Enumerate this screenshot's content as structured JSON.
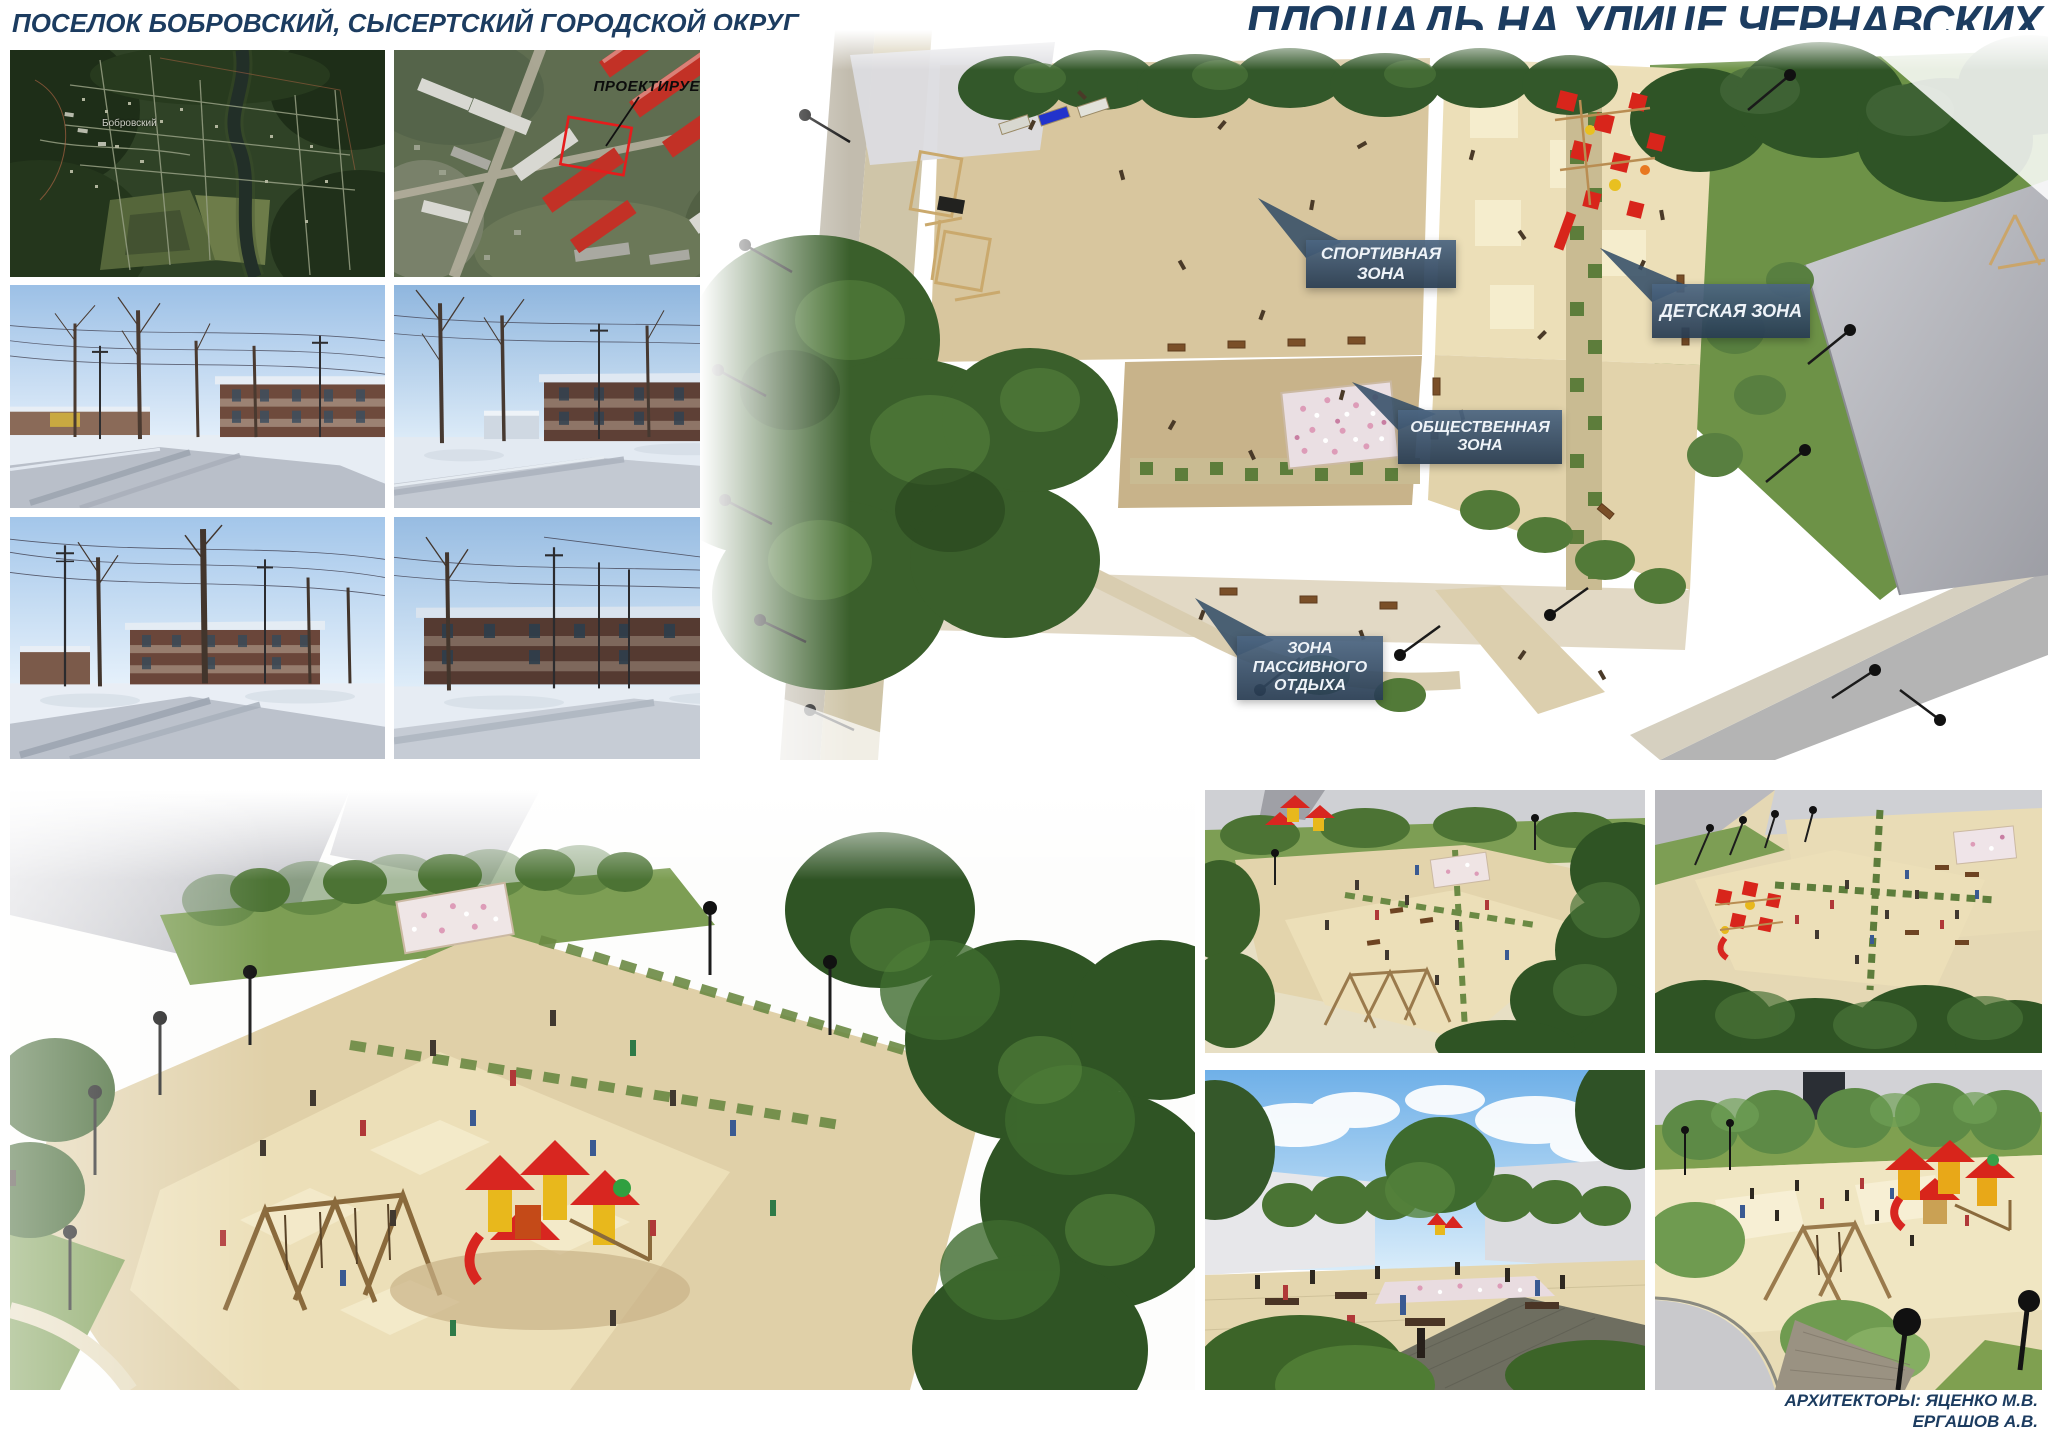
{
  "header": {
    "location_title": "ПОСЕЛОК БОБРОВСКИЙ, СЫСЕРТСКИЙ ГОРОДСКОЙ ОКРУГ",
    "project_title": "ПЛОЩАДЬ НА УЛИЦЕ ЧЕРНАВСКИХ"
  },
  "site_maps": {
    "settlement_label": "Бобровский",
    "project_site_label": "ПРОЕКТИРУЕМЫЙ УЧАСТОК"
  },
  "masterplan": {
    "zones": [
      {
        "id": "sport",
        "label": "СПОРТИВНАЯ ЗОНА"
      },
      {
        "id": "children",
        "label": "ДЕТСКАЯ ЗОНА"
      },
      {
        "id": "public",
        "label": "ОБЩЕСТВЕННАЯ ЗОНА"
      },
      {
        "id": "passive",
        "label": "ЗОНА ПАССИВНОГО ОТДЫХА"
      }
    ]
  },
  "credits": {
    "line1": "АРХИТЕКТОРЫ: ЯЦЕНКО М.В.",
    "line2": "ЕРГАШОВ А.В."
  },
  "colors": {
    "title_navy": "#1c3c60",
    "callout_blue": "#3c5a76",
    "plaza_beige": "#d9c7a0",
    "lawn_green": "#6f9448",
    "tree_green": "#35592a",
    "playground_red": "#d8251b",
    "parcel_red": "#e51c1c"
  }
}
